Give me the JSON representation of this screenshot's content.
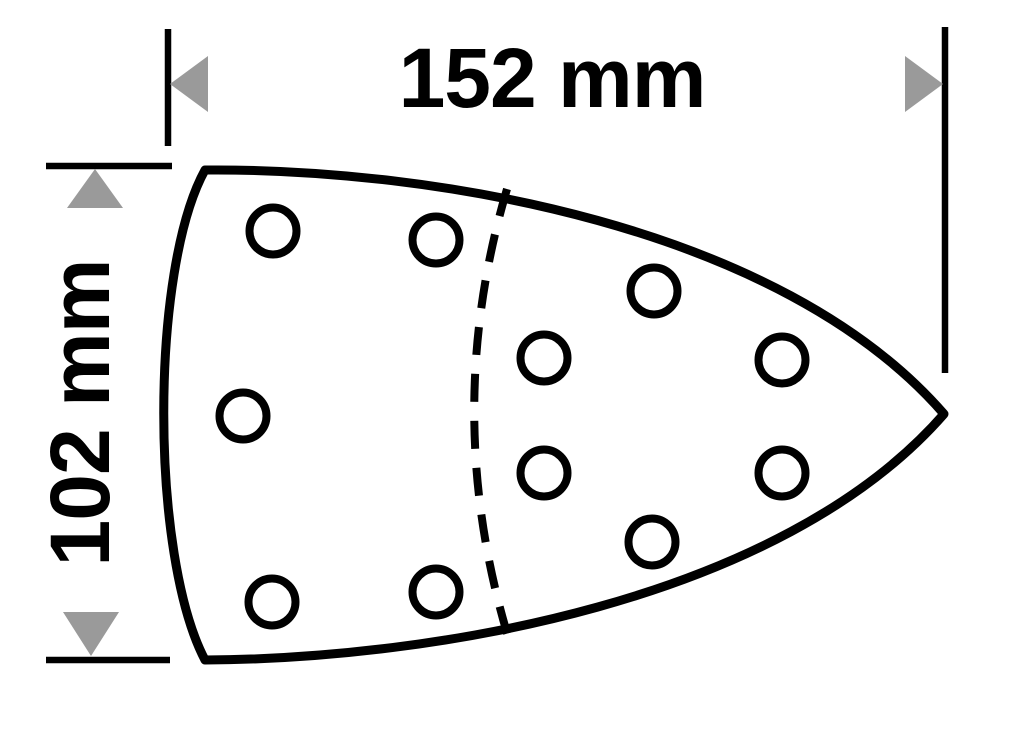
{
  "diagram": {
    "width_label": "152 mm",
    "height_label": "102 mm",
    "colors": {
      "stroke": "#000000",
      "arrow_fill": "#9a9a9a",
      "background": "#ffffff"
    },
    "holes": {
      "count": 11,
      "radius": 23.5,
      "centers": [
        [
          273,
          231
        ],
        [
          436,
          240
        ],
        [
          654,
          291
        ],
        [
          544,
          358
        ],
        [
          782,
          360
        ],
        [
          243,
          416
        ],
        [
          544,
          473
        ],
        [
          782,
          473
        ],
        [
          652,
          542
        ],
        [
          272,
          602
        ],
        [
          436,
          592
        ]
      ]
    }
  }
}
